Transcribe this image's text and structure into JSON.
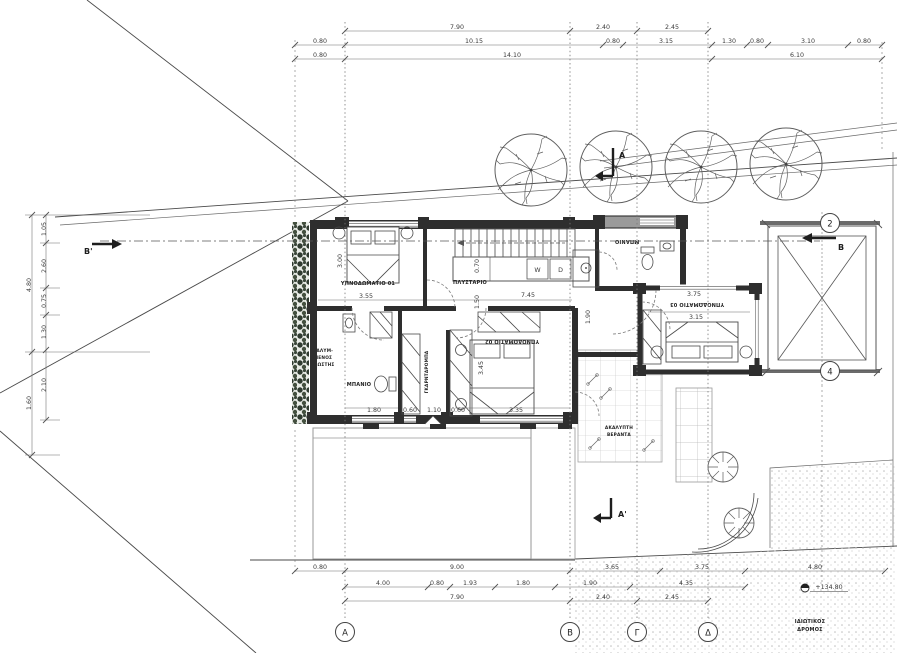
{
  "drawing": {
    "rooms": {
      "bedroom1": "ΥΠΝΟΔΩΜΑΤΙΟ 01",
      "laundry": "ΠΛΥΣΤΑΡΙΟ",
      "bath1": "ΜΠΑΝΙΟ",
      "wardrobe": "ΓΚΑΡΝΤΑΡΟΜΠΑ",
      "bedroom2": "ΥΠΝΟΔΩΜΑΤΙΟ 02",
      "bath2": "ΜΠΑΝΙΟ",
      "bedroom3": "ΥΠΝΟΔΩΜΑΤΙΟ 03",
      "veranda_line1": "ΑΚΑΛΥΠΤΗ",
      "veranda_line2": "ΒΕΡΑΝΤΑ",
      "balcony_line1": "ΚΑΛΥΜ-",
      "balcony_line2": "ΜΕΝΟΣ",
      "balcony_line3": "ΕΞΩΣΤΗΣ"
    },
    "appliances": {
      "washer": "W",
      "dryer": "D"
    },
    "grid_columns": [
      "A",
      "B",
      "Γ",
      "Δ"
    ],
    "grid_rows": [
      "2",
      "4"
    ],
    "sections": {
      "a": "A",
      "a_prime": "A'",
      "b": "B",
      "b_prime": "B'"
    },
    "road": {
      "line1": "ΙΔΙΩΤΙΚΟΣ",
      "line2": "ΔΡΟΜΟΣ",
      "level": "+134.80"
    },
    "dims_top_row1": [
      "7.90",
      "2.40",
      "2.45"
    ],
    "dims_top_row2": [
      "0.80",
      "10.15",
      "0.80",
      "3.15",
      "1.30",
      "0.80",
      "3.10",
      "0.80"
    ],
    "dims_top_row3": [
      "0.80",
      "14.10",
      "6.10"
    ],
    "dims_bottom_row1": [
      "0.80",
      "9.00",
      "3.65",
      "3.75",
      "4.80"
    ],
    "dims_bottom_row2": [
      "4.00",
      "0.80",
      "1.93",
      "1.80",
      "1.90",
      "4.35"
    ],
    "dims_bottom_row3": [
      "7.90",
      "2.40",
      "2.45"
    ],
    "dims_left_outer": [
      "4.80",
      "1.60"
    ],
    "dims_left_inner": [
      "1.05",
      "2.60",
      "0.75",
      "1.30",
      "2.10"
    ],
    "dims_interior": {
      "bed1_w": "3.55",
      "bed1_d": "3.00",
      "laundry_w": "7.45",
      "counter_d": "0.70",
      "hall_w": "1.50",
      "corridor": "1.90",
      "bed2_w": "3.35",
      "bed2_d": "3.45",
      "bed3_w": "3.75",
      "bed3_in": "3.15",
      "bath_row": [
        "1.80",
        "0.60",
        "1.10",
        "0.60"
      ]
    },
    "colors": {
      "wall": "#2e2e2e",
      "line": "#555555",
      "plants": "#3a463a",
      "road_dots": "#b5b5b5"
    }
  }
}
